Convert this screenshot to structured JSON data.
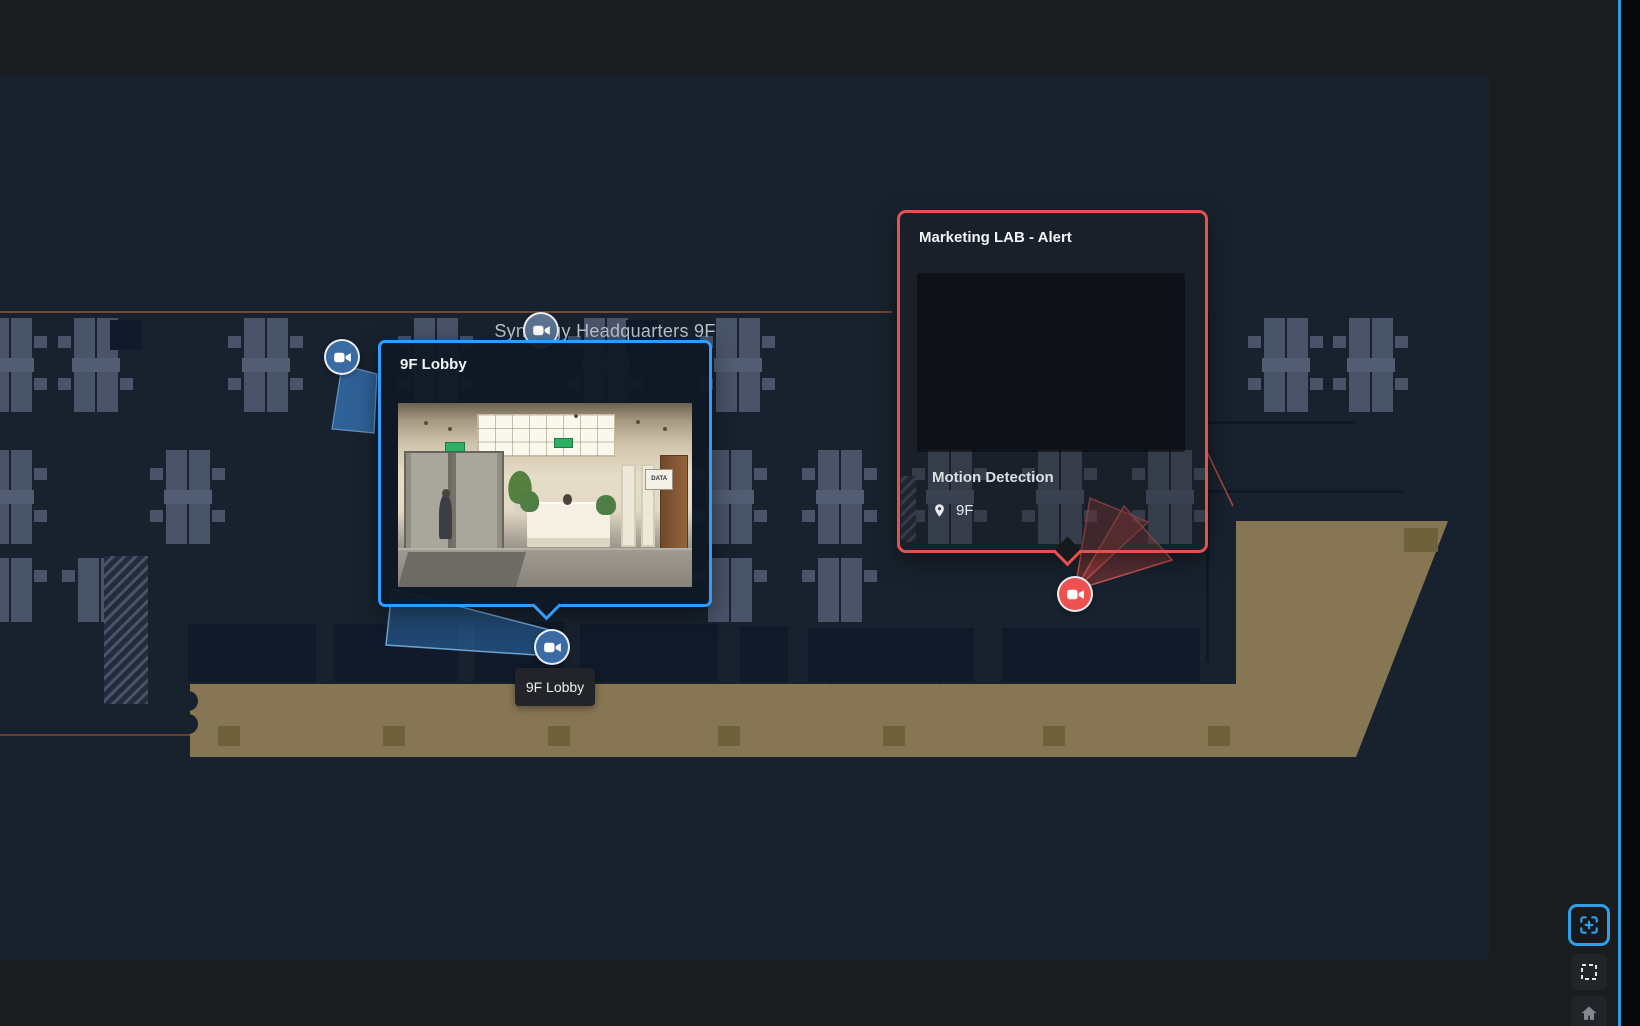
{
  "map": {
    "title": "Synology Headquarters 9F",
    "background_color": "#18222e",
    "accent_blue": "#2f9dfc",
    "alert_red": "#e4514e",
    "terrace_tan": "#8b7a56"
  },
  "camera_popup": {
    "title": "9F Lobby",
    "scene_sign_text": "DATA"
  },
  "alert_popup": {
    "title": "Marketing LAB - Alert",
    "event_type": "Motion Detection",
    "location_label": "9F"
  },
  "camera_tooltip": {
    "label": "9F Lobby"
  },
  "cameras": [
    {
      "id": "camera-west",
      "color": "blue"
    },
    {
      "id": "camera-north",
      "color": "blue"
    },
    {
      "id": "camera-south",
      "name": "9F Lobby",
      "color": "blue"
    },
    {
      "id": "camera-alert",
      "color": "red",
      "state": "alert"
    }
  ],
  "controls": [
    {
      "id": "fit-view",
      "icon": "frame-plus-icon",
      "active": true
    },
    {
      "id": "select-area",
      "icon": "dashed-square-icon",
      "active": false
    },
    {
      "id": "home",
      "icon": "home-icon",
      "active": false
    }
  ]
}
